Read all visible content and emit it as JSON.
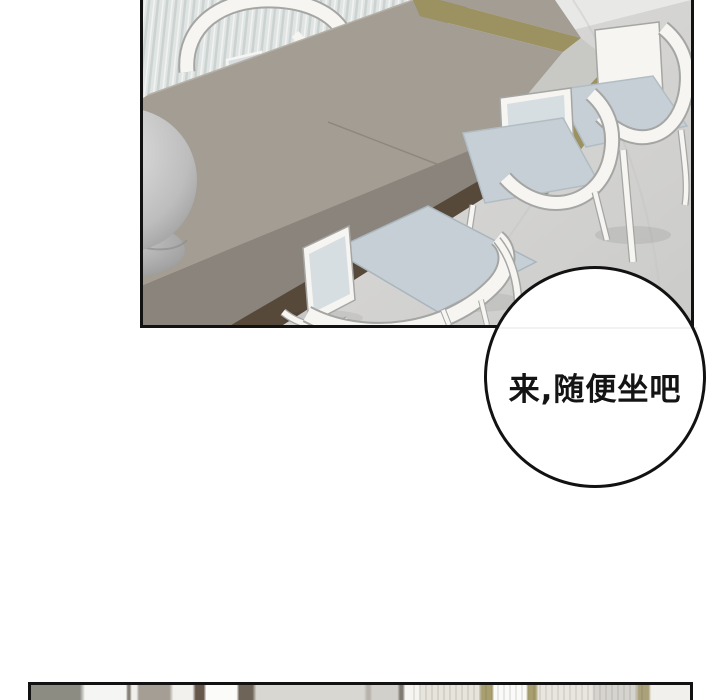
{
  "page": {
    "type": "webtoon-comic-page",
    "background_color": "#ffffff"
  },
  "top_panel": {
    "description": "3D-rendered dining room: long taupe dining table seen from above, white curved-back chairs with pale blue-gray cushions, striped gray curtain, dark wood floor strip, white marble floor, gray spherical ornament at left edge",
    "border_color": "#121212",
    "colors": {
      "floor": "#e8e8e7",
      "floor_shade": "#cbcbc9",
      "curtain": "#e0e4e3",
      "curtain_stripe": "#c9d1d0",
      "curtain_highlight": "#f3f5f4",
      "wood_floor": "#7e6e54",
      "wood_shadow": "#5d5040",
      "table_top": "#a39d94",
      "table_front": "#8a847c",
      "table_under_shadow": "#57493a",
      "table_end_face": "#c8c8c4",
      "khaki_accent": "#9c9160",
      "chair_white": "#f6f5f2",
      "chair_outline": "#a5a6a4",
      "cushion": "#c5cfd5",
      "back_inset": "#d6dee2",
      "sphere_light": "#e6e6e6",
      "sphere_dark": "#999999",
      "vein": "#c6c6c4"
    }
  },
  "speech_bubble": {
    "text": "来,随便坐吧",
    "fill": "#ffffff",
    "border_color": "#121212",
    "text_color": "#141414"
  },
  "bottom_panel": {
    "description": "top sliver of the next panel: blurred interior with windows, curtains and khaki wall strips",
    "border_color": "#121212"
  }
}
